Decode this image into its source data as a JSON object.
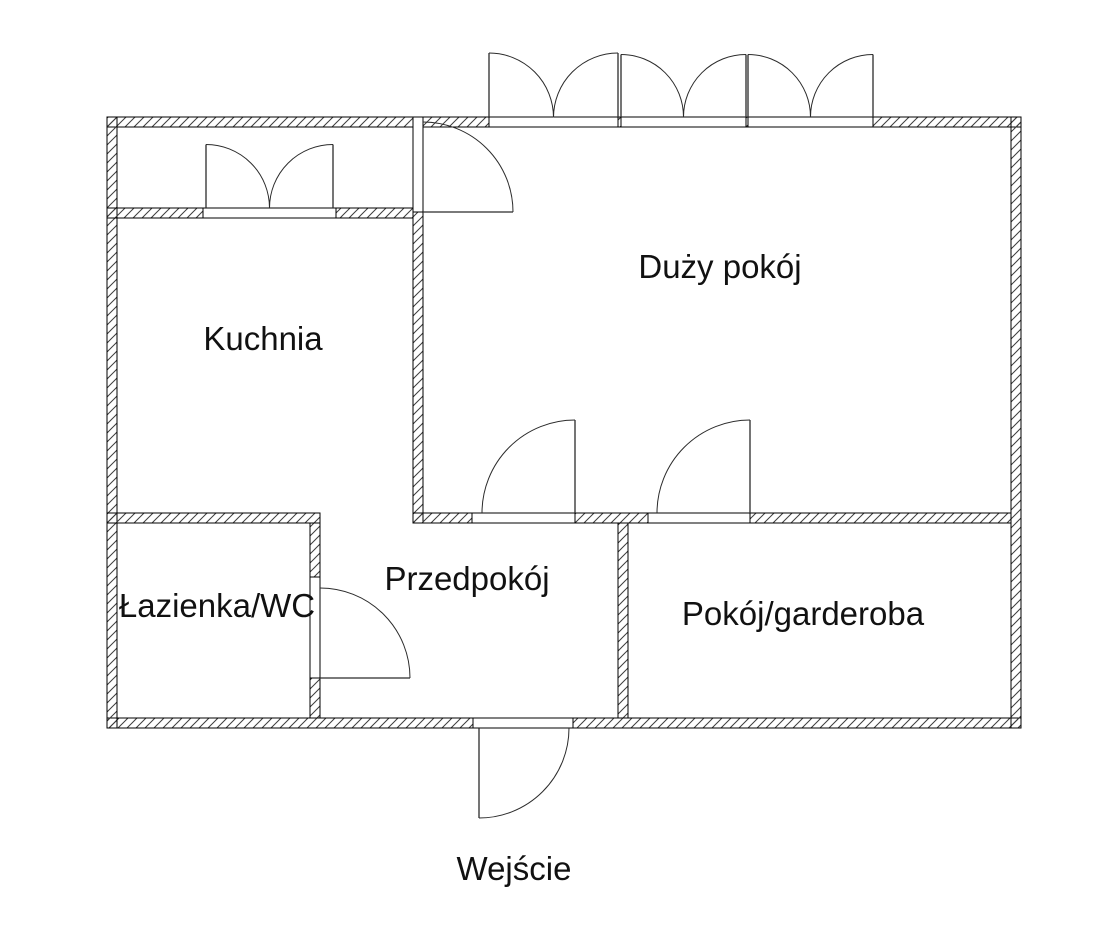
{
  "floor_plan": {
    "rooms": [
      {
        "id": "kuchnia",
        "label": "Kuchnia"
      },
      {
        "id": "duzy_pokoj",
        "label": "Duży pokój"
      },
      {
        "id": "przedpokoj",
        "label": "Przedpokój"
      },
      {
        "id": "lazienka_wc",
        "label": "Łazienka/WC"
      },
      {
        "id": "pokoj_garderoba",
        "label": "Pokój/garderoba"
      }
    ],
    "entrance": {
      "label": "Wejście"
    },
    "colors": {
      "background": "#ffffff",
      "wall_outline": "#000000",
      "wall_hatch": "#3d3d3d",
      "door_line": "#2b2b2b",
      "label_text": "#111111"
    }
  }
}
